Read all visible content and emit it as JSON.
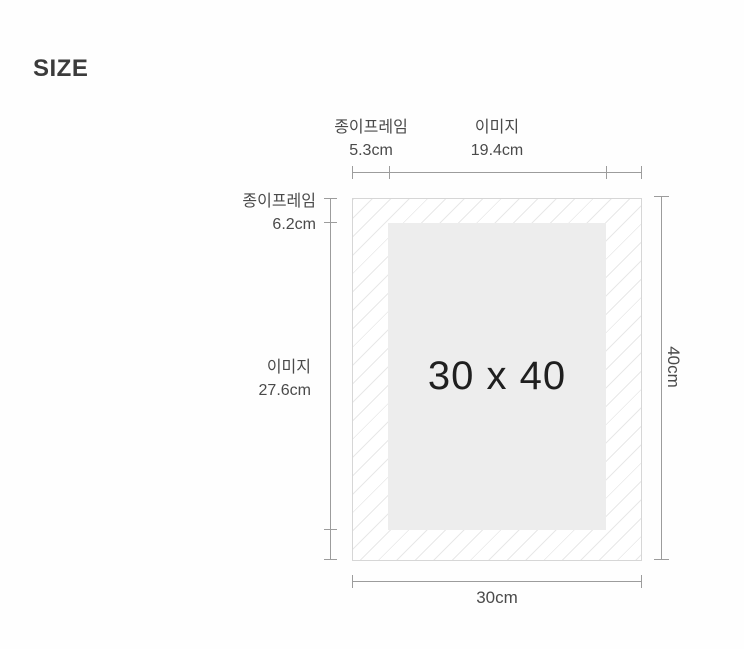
{
  "title": "SIZE",
  "diagram": {
    "center_size_label": "30 x 40",
    "measurements": {
      "top": {
        "paper_frame": {
          "label": "종이프레임",
          "value": "5.3cm"
        },
        "image": {
          "label": "이미지",
          "value": "19.4cm"
        }
      },
      "left": {
        "paper_frame": {
          "label": "종이프레임",
          "value": "6.2cm"
        },
        "image": {
          "label": "이미지",
          "value": "27.6cm"
        }
      },
      "right": {
        "height_value": "40cm"
      },
      "bottom": {
        "width_value": "30cm"
      }
    }
  },
  "colors": {
    "background": "#fefefe",
    "title_text": "#3b3b3b",
    "label_text": "#4a4a4a",
    "measure_line": "#9c9c9c",
    "frame_border": "#d6d6d6",
    "hatch_line": "#e8e8e8",
    "image_fill": "#ededed",
    "center_text": "#1f1f1f"
  }
}
